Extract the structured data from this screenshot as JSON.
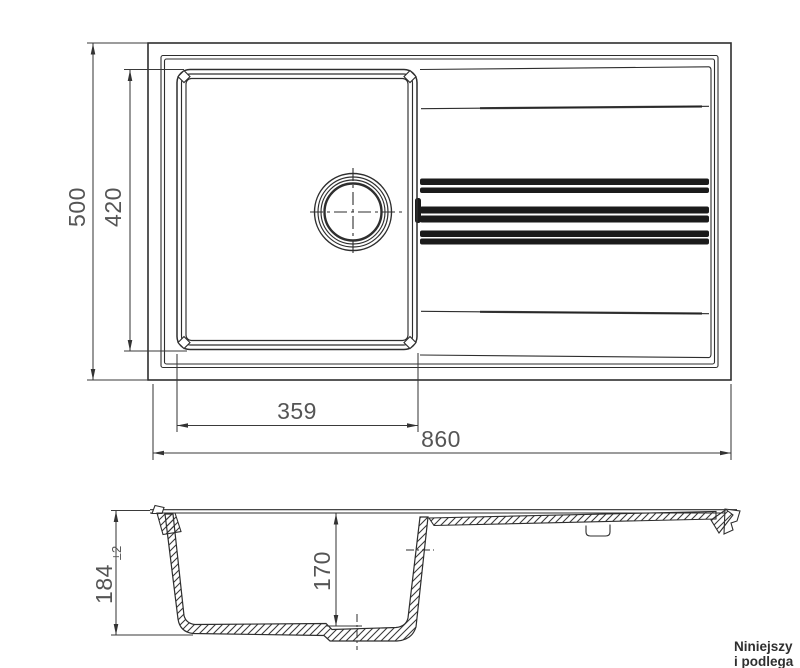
{
  "drawing": {
    "title_semantic": "kitchen sink technical drawing, top view and section view",
    "dimensions": {
      "overall_length": "860",
      "overall_depth": "500",
      "bowl_opening_depth": "420",
      "bowl_opening_length": "359",
      "total_height": "184",
      "total_height_tolerance": "±2",
      "bowl_depth": "170"
    },
    "note": {
      "line1": "Niniejszy",
      "line2": "i podlega"
    },
    "colors": {
      "background": "#ffffff",
      "line": "#2e2e2e",
      "groove_fill": "#1b1b1b",
      "dimension_text": "#555555",
      "note_text": "#2f2f2f"
    }
  }
}
